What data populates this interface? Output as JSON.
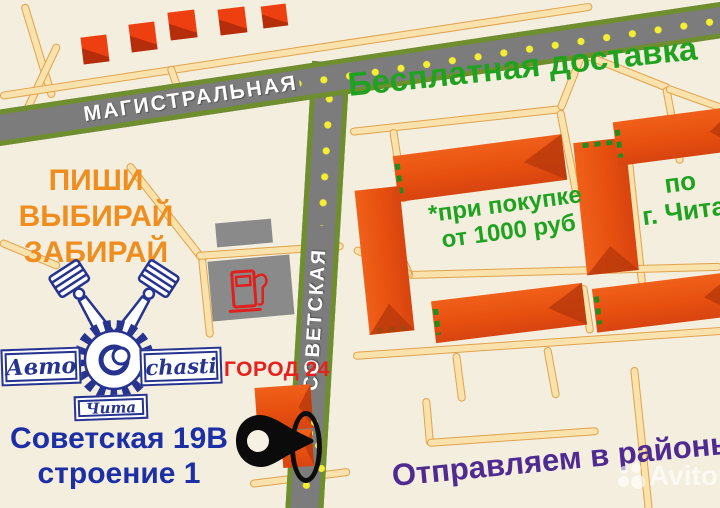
{
  "map": {
    "streets": {
      "main_horizontal": "МАГИСТРАЛЬНАЯ",
      "main_vertical": "СОВЕТСКАЯ"
    },
    "landmark_icons": {
      "gas_station": "fuel-pump-icon",
      "store_location": "map-pin-icon",
      "route_markers": "yellow-dots"
    }
  },
  "promo": {
    "free_delivery": "Бесплатная доставка",
    "delivery_condition_line1": "*при покупке",
    "delivery_condition_line2": "от 1000 руб",
    "delivery_area_line1": "по",
    "delivery_area_line2": "г. Чита",
    "cta_line1": "ПИШИ",
    "cta_line2": "ВЫБИРАЙ",
    "cta_line3": "ЗАБИРАЙ",
    "districts": "Отправляем в районы"
  },
  "store": {
    "logo_left": "Авто",
    "logo_right": "chasti",
    "logo_city": "Чита",
    "logo_icons": "pistons-and-gear-icon",
    "mall_name": "ГОРОД 24",
    "address_line1": "Советская 19В",
    "address_line2": "строение 1"
  },
  "watermark": {
    "brand": "Avito"
  },
  "colors": {
    "background": "#f3eedd",
    "road_fill": "#7c7c7c",
    "road_border": "#6f8f2f",
    "street_fill": "#f9e2ac",
    "street_border": "#e2a24c",
    "building": "#e7500f",
    "building_shade": "#bb3a0c",
    "route_dot": "#f4ef32",
    "text_green": "#1fa21f",
    "text_orange": "#ef8e1e",
    "text_blue": "#1d2fa5",
    "text_red": "#e6201e",
    "text_purple": "#4f2b91",
    "logo_blue": "#26338f"
  }
}
